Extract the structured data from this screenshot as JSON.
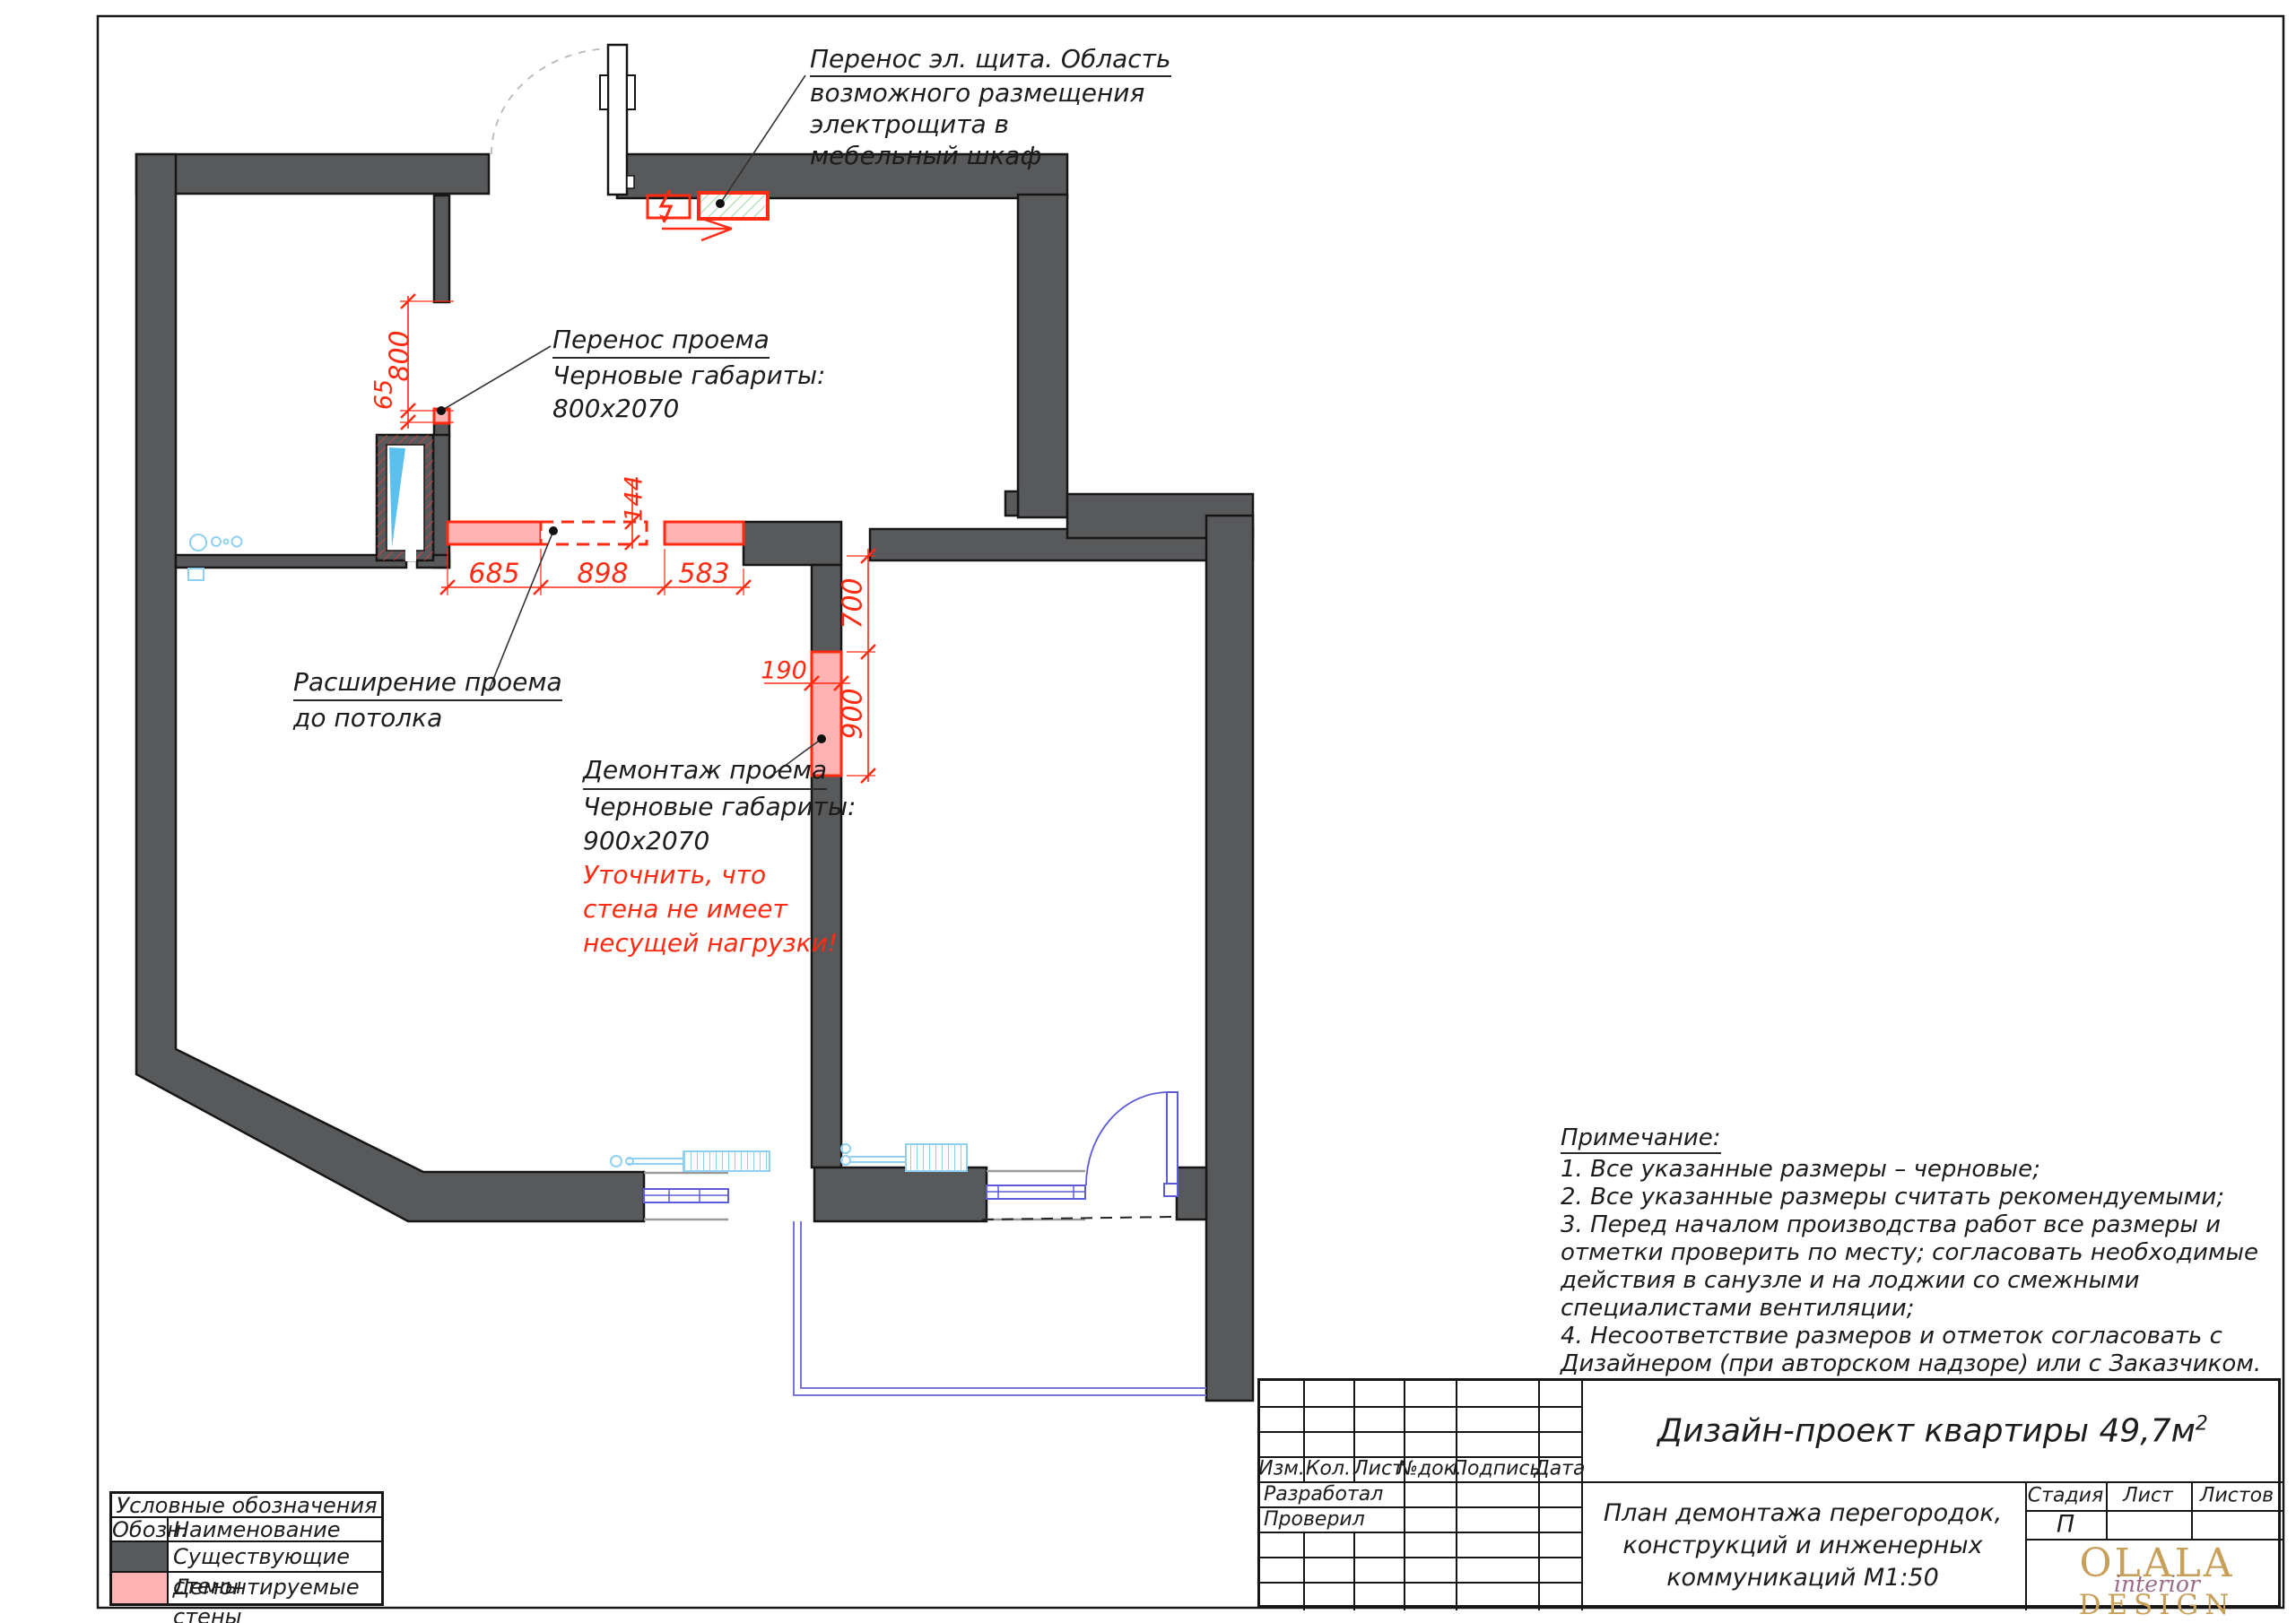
{
  "annotations": {
    "panel": {
      "line1": "Перенос эл. щита. Область",
      "line2": "возможного размещения",
      "line3": "электрощита в",
      "line4": "мебельный шкаф"
    },
    "opening_move": {
      "line1": "Перенос проема",
      "line2": "Черновые габариты:",
      "line3": "800x2070"
    },
    "widen": {
      "line1": "Расширение проема",
      "line2": "до потолка"
    },
    "demolish": {
      "line1": "Демонтаж проема",
      "line2": "Черновые габариты:",
      "line3": "900x2070",
      "warn1": "Уточнить, что",
      "warn2": "стена не имеет",
      "warn3": "несущей нагрузки!"
    }
  },
  "dims": {
    "d800": "800",
    "d65": "65",
    "d144": "144",
    "d685": "685",
    "d898": "898",
    "d583": "583",
    "d700": "700",
    "d900": "900",
    "d190": "190"
  },
  "notes": {
    "title": "Примечание:",
    "lines": [
      "1. Все указанные размеры – черновые;",
      "2. Все указанные размеры считать рекомендуемыми;",
      "3. Перед началом производства работ все размеры и",
      "отметки проверить по месту; согласовать необходимые",
      "действия в санузле и на лоджии со смежными",
      "специалистами вентиляции;",
      "4. Несоответствие размеров и отметок согласовать с",
      "Дизайнером (при авторском надзоре) или с Заказчиком."
    ]
  },
  "legend": {
    "header": "Условные обозначения",
    "col_symbol": "Обозн.",
    "col_name": "Наименование",
    "row_existing": "Существующие стены",
    "row_demolished": "Демонтируемые стены"
  },
  "titleblock": {
    "project_title": "Дизайн-проект квартиры 49,7м",
    "project_title_sup": "2",
    "sheet_title_line1": "План демонтажа перегородок,",
    "sheet_title_line2": "конструкций и инженерных",
    "sheet_title_line3": "коммуникаций М1:50",
    "col_izm": "Изм.",
    "col_kol": "Кол.",
    "col_list": "Лист",
    "col_ndok": "№док.",
    "col_podpis": "Подпись",
    "col_data": "Дата",
    "role_developed": "Разработал",
    "role_checked": "Проверил",
    "stage_label": "Стадия",
    "sheet_label": "Лист",
    "sheets_label": "Листов",
    "stage_value": "П",
    "logo_line1": "OLALA",
    "logo_line2": "interior",
    "logo_line3": "DESIGN"
  },
  "colors": {
    "existing_wall": "#58595B",
    "demolished_fill": "#FFB2B2",
    "demolition_red": "#FF2A12",
    "fixture_blue": "#8FD0F0",
    "window_blue": "#5B5BDB",
    "hatch_green": "#A8DCB0",
    "logo_gold": "#C8A05A",
    "logo_script": "#9B6B8A"
  }
}
